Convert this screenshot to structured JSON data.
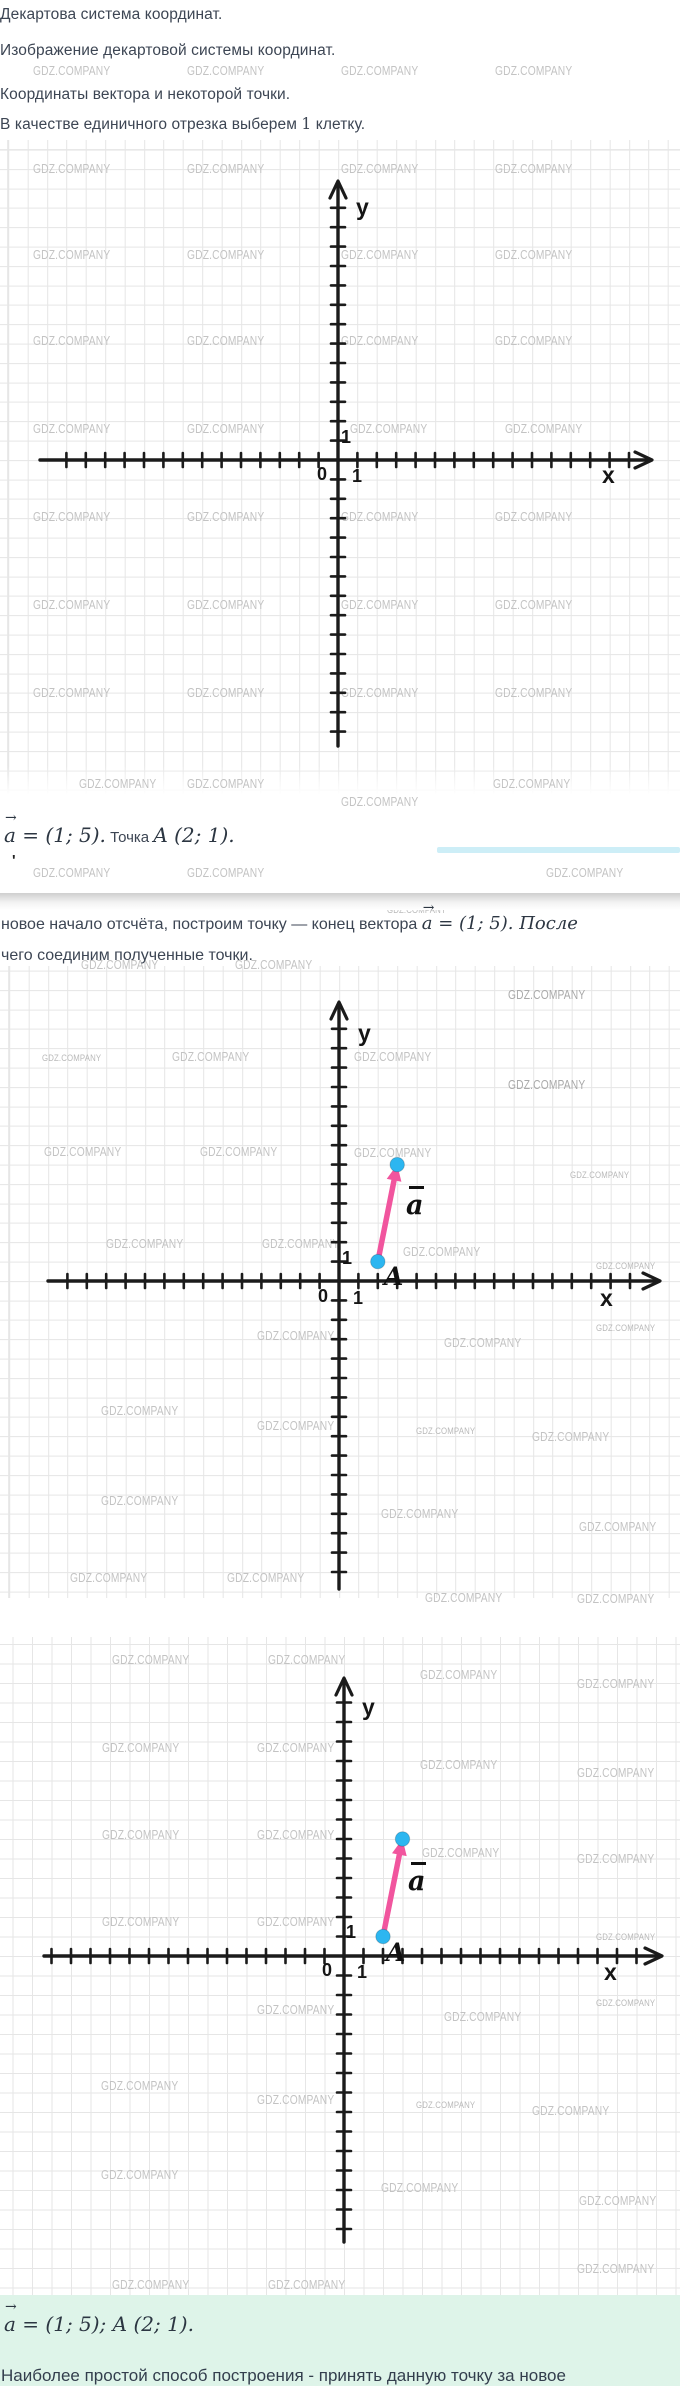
{
  "page": {
    "bg": "#ffffff",
    "accent_pink": "#f1559e",
    "accent_cyan": "#2cb6f0",
    "axis_color": "#1b1b1b",
    "grid_color": "#e6e6e6",
    "mint_bg": "#def4e9",
    "text_dark": "#3d4654"
  },
  "header": {
    "line1": "Декартова система координат.",
    "line2": "Изображение декартовой системы координат.",
    "line3": "Координаты вектора и некоторой точки.",
    "line4_pre": "В качестве единичного отрезка выберем ",
    "line4_num": "1",
    "line4_post": " клетку."
  },
  "watermark": {
    "text": "GDZ.COMPANY"
  },
  "math_line1": {
    "vec_a": "a",
    "arrow": "→",
    "eq": " = (1; 5).",
    "word": " Точка ",
    "point": "A (2; 1)."
  },
  "artifact_mark": "'",
  "para1": {
    "pre": "новое начало отсчёта, построим точку — конец вектора ",
    "vec_a": "a",
    "arrow": "→",
    "post": " = (1; 5). После"
  },
  "para2": "чего соединим полученные точки.",
  "result": {
    "vec_a": "a",
    "arrow": "→",
    "rest": " = (1; 5); A (2; 1)."
  },
  "footer_cut": "Наиболее простой способ построения - принять данную точку за новое",
  "chart_data": [
    {
      "id": "plot1",
      "type": "scatter",
      "title": "Декартова система координат (пустая сетка)",
      "x_label": "x",
      "y_label": "y",
      "origin_label": "0",
      "x_unit_label": "1",
      "y_unit_label": "1",
      "unit_per_cell": 1,
      "grid": true,
      "x_range": [
        -14,
        15
      ],
      "y_range": [
        -14,
        13
      ],
      "points": [],
      "vectors": []
    },
    {
      "id": "plot2",
      "type": "scatter",
      "title": "Вектор a = (1; 5) от точки A (2; 1)",
      "x_label": "x",
      "y_label": "y",
      "origin_label": "0",
      "x_unit_label": "1",
      "y_unit_label": "1",
      "unit_per_cell": 1,
      "grid": true,
      "x_range": [
        -14,
        15
      ],
      "y_range": [
        -15,
        13
      ],
      "points": [
        {
          "x": 2,
          "y": 1,
          "label": "A"
        },
        {
          "x": 3,
          "y": 6,
          "label": ""
        }
      ],
      "vectors": [
        {
          "name": "a",
          "decoration": "bar",
          "from": [
            2,
            1
          ],
          "to": [
            3,
            6
          ],
          "color": "#f1559e"
        }
      ]
    },
    {
      "id": "plot3",
      "type": "scatter",
      "title": "Вектор a = (1; 5) от точки A (2; 1)",
      "x_label": "x",
      "y_label": "y",
      "origin_label": "0",
      "x_unit_label": "1",
      "y_unit_label": "1",
      "unit_per_cell": 1,
      "grid": true,
      "x_range": [
        -15,
        15
      ],
      "y_range": [
        -14,
        13
      ],
      "points": [
        {
          "x": 2,
          "y": 1,
          "label": "A"
        },
        {
          "x": 3,
          "y": 6,
          "label": ""
        }
      ],
      "vectors": [
        {
          "name": "a",
          "decoration": "bar",
          "from": [
            2,
            1
          ],
          "to": [
            3,
            6
          ],
          "color": "#f1559e"
        }
      ]
    }
  ],
  "wm_positions": [
    [
      33,
      64,
      0
    ],
    [
      187,
      64,
      0
    ],
    [
      341,
      64,
      0
    ],
    [
      495,
      64,
      0
    ],
    [
      33,
      162,
      0
    ],
    [
      187,
      162,
      0
    ],
    [
      341,
      162,
      0
    ],
    [
      495,
      162,
      0
    ],
    [
      33,
      248,
      0
    ],
    [
      187,
      248,
      0
    ],
    [
      341,
      248,
      0
    ],
    [
      495,
      248,
      0
    ],
    [
      33,
      334,
      0
    ],
    [
      187,
      334,
      0
    ],
    [
      341,
      334,
      0
    ],
    [
      495,
      334,
      0
    ],
    [
      33,
      422,
      0
    ],
    [
      187,
      422,
      0
    ],
    [
      350,
      422,
      0
    ],
    [
      505,
      422,
      0
    ],
    [
      33,
      510,
      0
    ],
    [
      187,
      510,
      0
    ],
    [
      341,
      510,
      0
    ],
    [
      495,
      510,
      0
    ],
    [
      33,
      598,
      0
    ],
    [
      187,
      598,
      0
    ],
    [
      341,
      598,
      0
    ],
    [
      495,
      598,
      0
    ],
    [
      33,
      686,
      0
    ],
    [
      187,
      686,
      0
    ],
    [
      341,
      686,
      0
    ],
    [
      495,
      686,
      0
    ],
    [
      79,
      777,
      0
    ],
    [
      187,
      777,
      0
    ],
    [
      493,
      777,
      0
    ],
    [
      341,
      795,
      0
    ],
    [
      33,
      866,
      0
    ],
    [
      187,
      866,
      0
    ],
    [
      546,
      866,
      0
    ],
    [
      387,
      905,
      2
    ],
    [
      81,
      958,
      0
    ],
    [
      235,
      958,
      0
    ],
    [
      508,
      988,
      1
    ],
    [
      42,
      1053,
      2
    ],
    [
      172,
      1050,
      0
    ],
    [
      354,
      1050,
      0
    ],
    [
      508,
      1078,
      1
    ],
    [
      44,
      1145,
      0
    ],
    [
      200,
      1145,
      0
    ],
    [
      354,
      1146,
      0
    ],
    [
      570,
      1170,
      2
    ],
    [
      106,
      1237,
      0
    ],
    [
      262,
      1237,
      0
    ],
    [
      403,
      1245,
      0
    ],
    [
      596,
      1261,
      2
    ],
    [
      257,
      1329,
      0
    ],
    [
      444,
      1336,
      0
    ],
    [
      596,
      1323,
      2
    ],
    [
      101,
      1404,
      0
    ],
    [
      257,
      1419,
      0
    ],
    [
      416,
      1426,
      2
    ],
    [
      532,
      1430,
      0
    ],
    [
      101,
      1494,
      0
    ],
    [
      381,
      1507,
      0
    ],
    [
      579,
      1520,
      0
    ],
    [
      70,
      1571,
      0
    ],
    [
      227,
      1571,
      0
    ],
    [
      425,
      1591,
      0
    ],
    [
      577,
      1592,
      0
    ],
    [
      112,
      1653,
      0
    ],
    [
      268,
      1653,
      0
    ],
    [
      420,
      1668,
      0
    ],
    [
      577,
      1677,
      0
    ],
    [
      102,
      1741,
      0
    ],
    [
      257,
      1741,
      0
    ],
    [
      420,
      1758,
      0
    ],
    [
      577,
      1766,
      0
    ],
    [
      102,
      1828,
      0
    ],
    [
      257,
      1828,
      0
    ],
    [
      422,
      1846,
      0
    ],
    [
      577,
      1852,
      0
    ],
    [
      102,
      1915,
      0
    ],
    [
      257,
      1915,
      0
    ],
    [
      596,
      1932,
      2
    ],
    [
      257,
      2003,
      0
    ],
    [
      444,
      2010,
      0
    ],
    [
      596,
      1998,
      2
    ],
    [
      101,
      2079,
      0
    ],
    [
      257,
      2093,
      0
    ],
    [
      416,
      2100,
      2
    ],
    [
      532,
      2104,
      0
    ],
    [
      101,
      2168,
      0
    ],
    [
      381,
      2181,
      0
    ],
    [
      579,
      2194,
      0
    ],
    [
      112,
      2278,
      0
    ],
    [
      268,
      2278,
      0
    ],
    [
      577,
      2262,
      0
    ],
    [
      420,
      2297,
      0
    ],
    [
      600,
      2338,
      2
    ]
  ]
}
